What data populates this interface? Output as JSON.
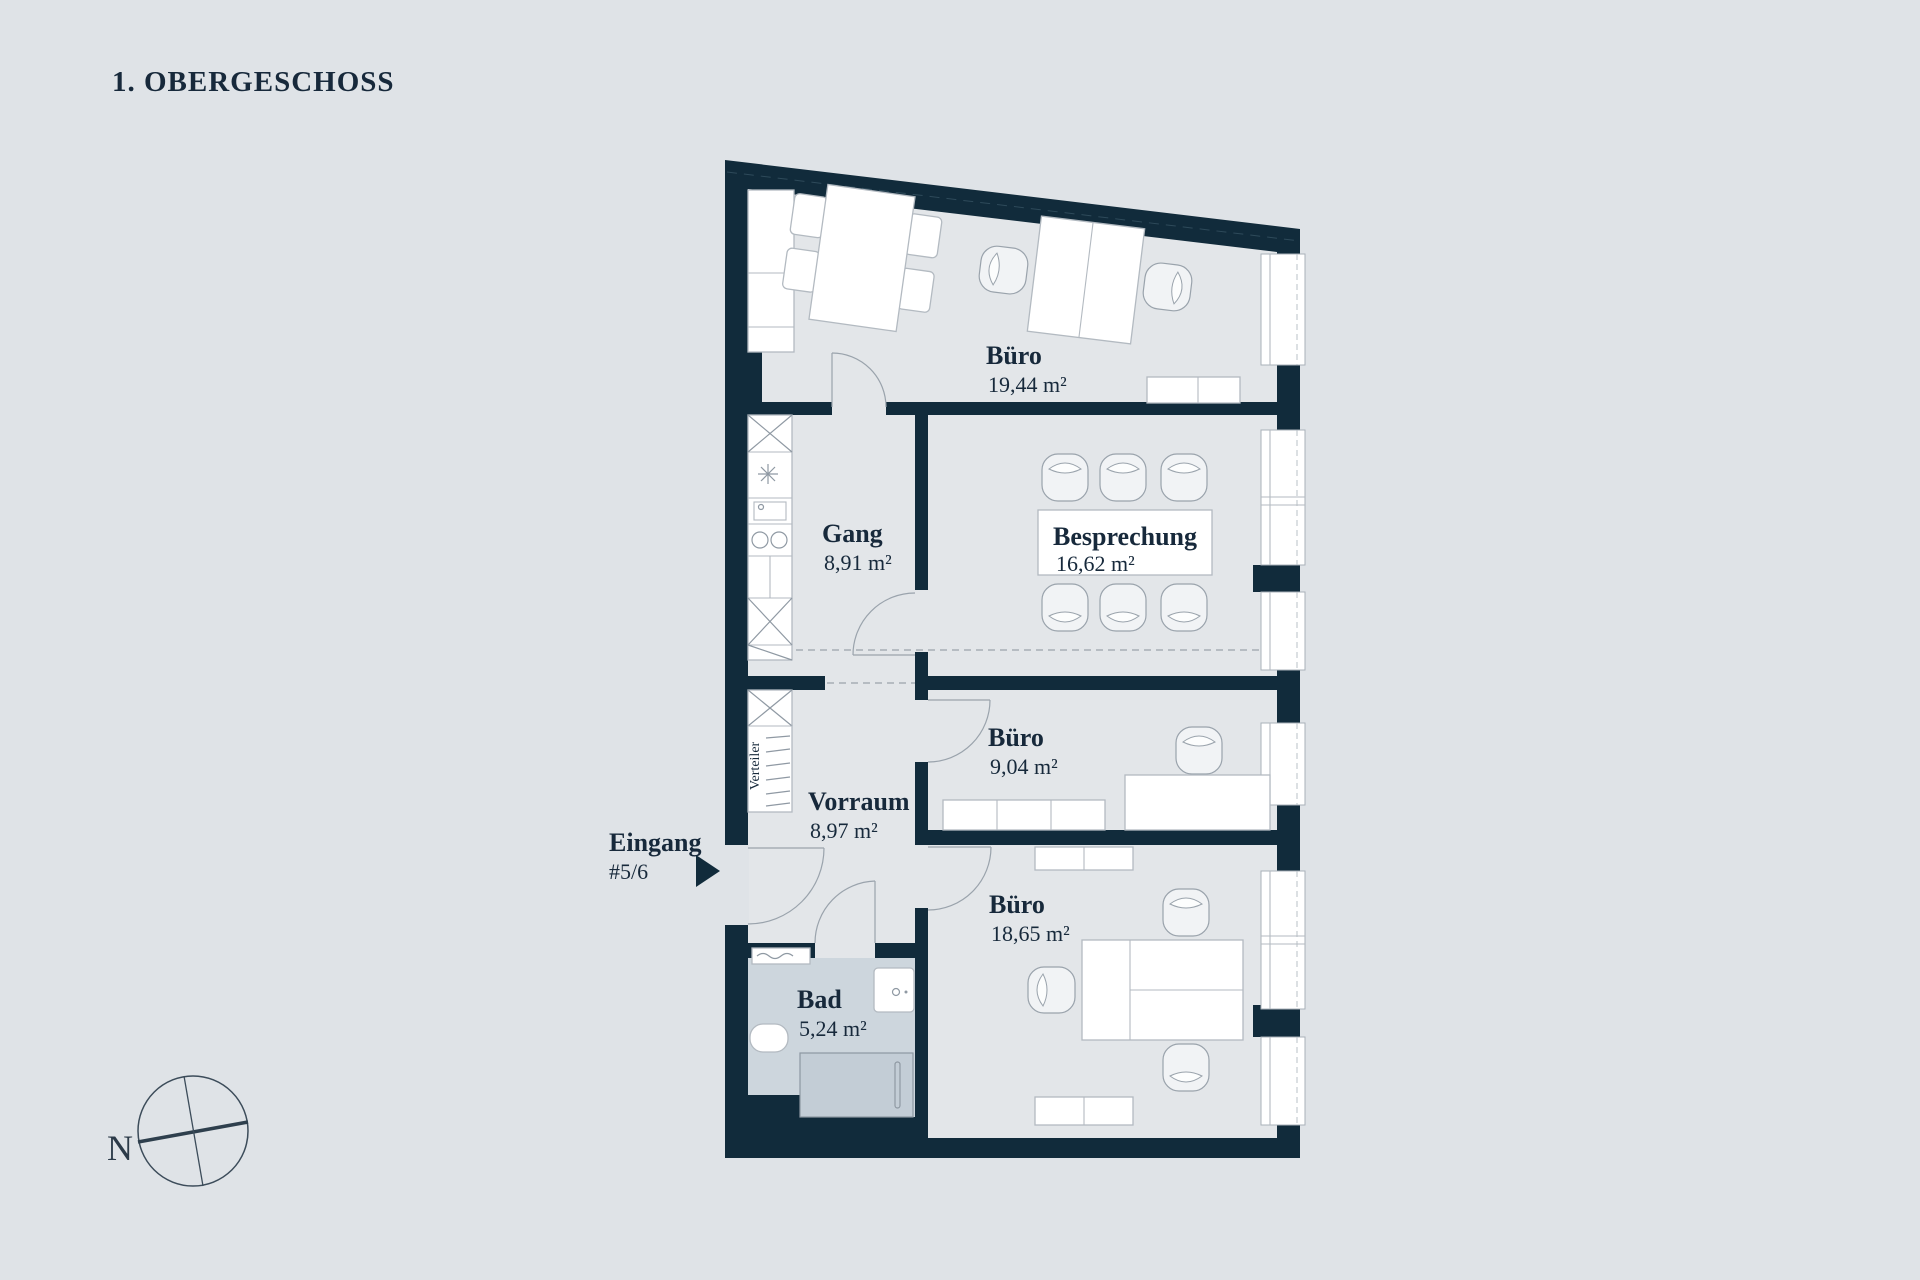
{
  "title": "1. OBERGESCHOSS",
  "colors": {
    "background": "#dfe3e7",
    "room": "#e3e6e9",
    "wall": "#112b3b",
    "badroom": "#cdd6dd",
    "tub": "#c3cdd6",
    "text": "#17293b",
    "outline": "#b3bac1"
  },
  "rooms": {
    "buero_top": {
      "name": "Büro",
      "area": "19,44 m²"
    },
    "gang": {
      "name": "Gang",
      "area": "8,91 m²"
    },
    "besprechung": {
      "name": "Besprechung",
      "area": "16,62 m²"
    },
    "buero_mid": {
      "name": "Büro",
      "area": "9,04 m²"
    },
    "vorraum": {
      "name": "Vorraum",
      "area": "8,97 m²"
    },
    "buero_bottom": {
      "name": "Büro",
      "area": "18,65 m²"
    },
    "bad": {
      "name": "Bad",
      "area": "5,24 m²"
    }
  },
  "entrance": {
    "label": "Eingang",
    "unit": "#5/6"
  },
  "fixtures": {
    "distributor": "Verteiler"
  },
  "compass": {
    "north": "N"
  }
}
